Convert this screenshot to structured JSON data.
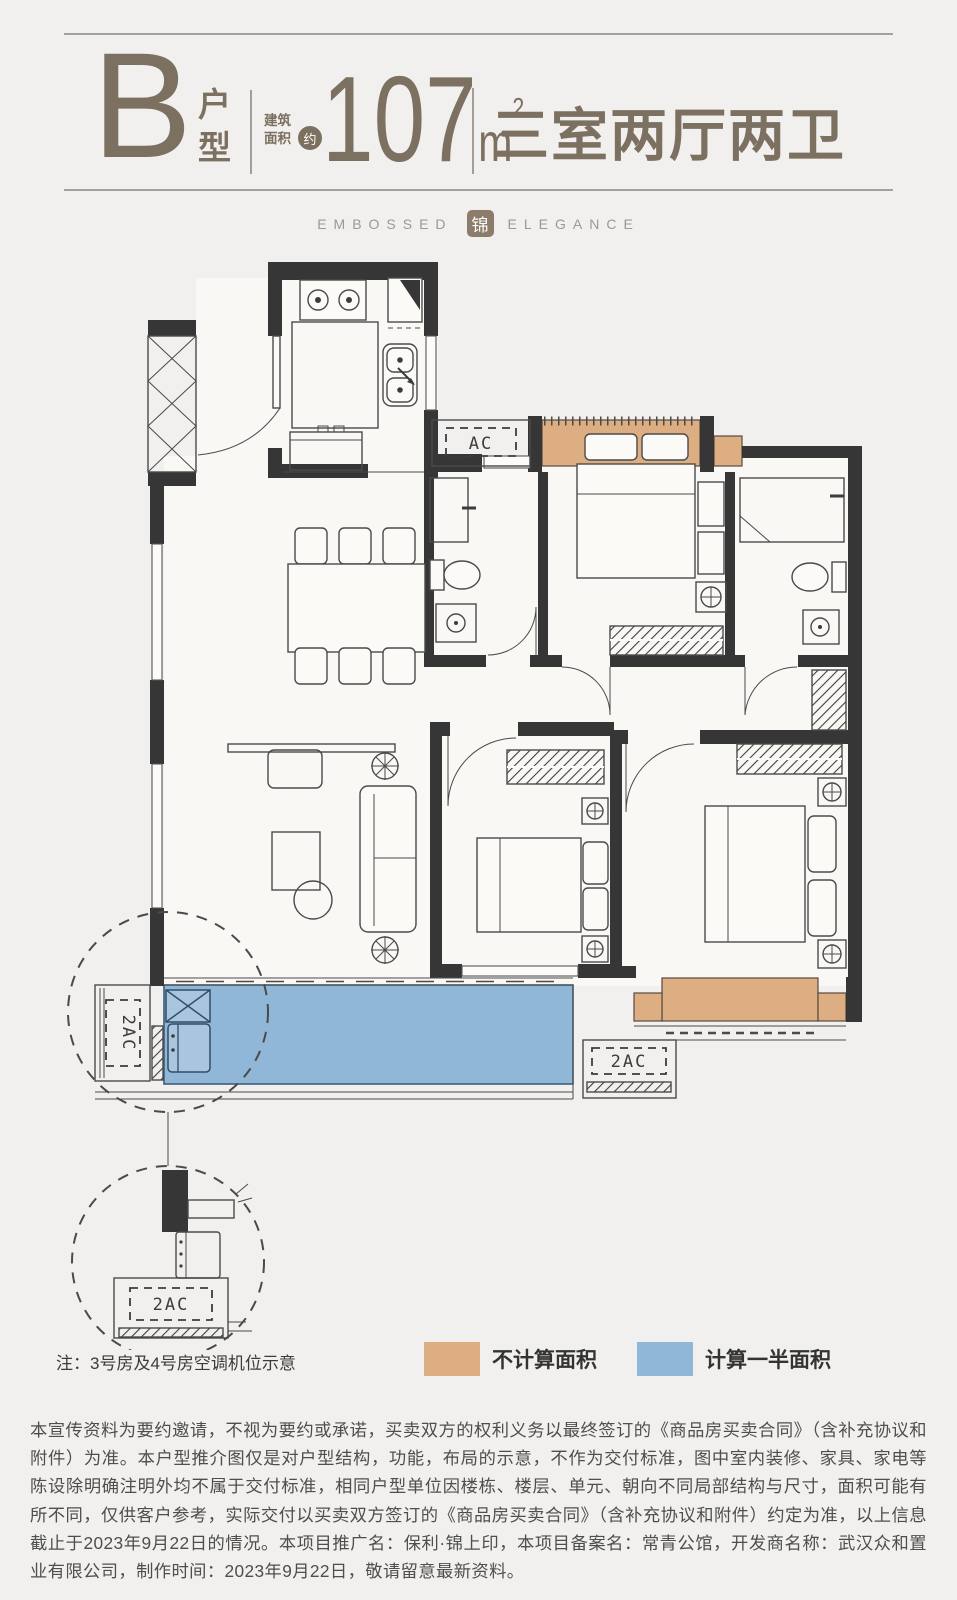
{
  "header": {
    "type_letter": "B",
    "type_label": "户型",
    "area_label": "建筑面积",
    "area_approx": "约",
    "area_value": "107",
    "area_unit": "m",
    "area_sup": "2",
    "layout_title": "三室两厅两卫"
  },
  "tagline": {
    "left": "EMBOSSED",
    "seal": "锦",
    "right": "ELEGANCE"
  },
  "plan": {
    "labels": {
      "ac": "AC",
      "ac2_balcony": "2AC",
      "ac2_right": "2AC",
      "ac2_detail": "2AC"
    },
    "colors": {
      "wall": "#363636",
      "not_counted": "#dcae81",
      "half_counted": "#91b7d8"
    }
  },
  "note": "注：3号房及4号房空调机位示意",
  "legend": {
    "items": [
      {
        "label": "不计算面积",
        "color": "#dcae81"
      },
      {
        "label": "计算一半面积",
        "color": "#91b7d8"
      }
    ]
  },
  "footer": {
    "disclaimer": "本宣传资料为要约邀请，不视为要约或承诺，买卖双方的权利义务以最终签订的《商品房买卖合同》（含补充协议和附件）为准。本户型推介图仅是对户型结构，功能，布局的示意，不作为交付标准，图中室内装修、家具、家电等陈设除明确注明外均不属于交付标准，相同户型单位因楼栋、楼层、单元、朝向不同局部结构与尺寸，面积可能有所不同，仅供客户参考，实际交付以买卖双方签订的《商品房买卖合同》（含补充协议和附件）约定为准，以上信息截止于2023年9月22日的情况。本项目推广名：保利·锦上印，本项目备案名：常青公馆，开发商名称：武汉众和置业有限公司，制作时间：2023年9月22日，敬请留意最新资料。"
  }
}
